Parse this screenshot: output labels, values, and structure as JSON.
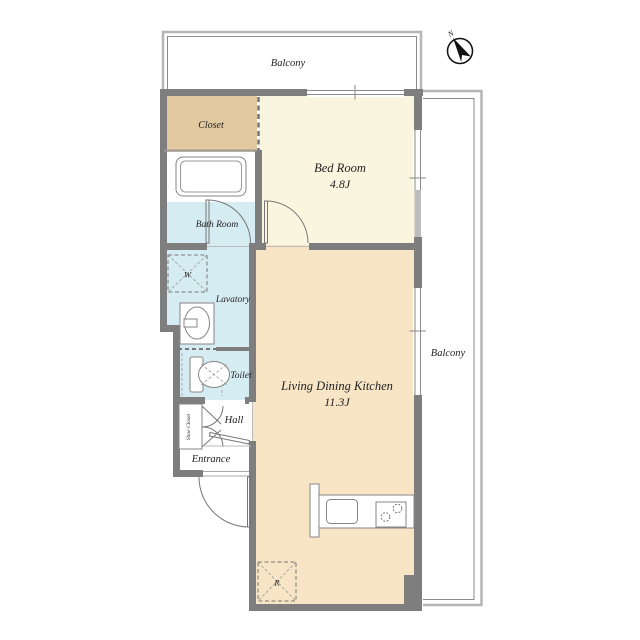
{
  "plan": {
    "compass": {
      "label": "N"
    },
    "balconies": {
      "top": "Balcony",
      "right": "Balcony"
    },
    "rooms": {
      "closet": {
        "label": "Closet"
      },
      "bedroom": {
        "label": "Bed Room",
        "size": "4.8J"
      },
      "bathroom": {
        "label": "Bath Room"
      },
      "lavatory": {
        "label": "Lavatory"
      },
      "toilet": {
        "label": "Toilet"
      },
      "hall": {
        "label": "Hall"
      },
      "shoe_closet": {
        "label": "Shoe Closet"
      },
      "entrance": {
        "label": "Entrance"
      },
      "ldk": {
        "label": "Living Dining Kitchen",
        "size": "11.3J"
      }
    },
    "symbols": {
      "washing_machine": "W",
      "refrigerator": "R"
    },
    "colors": {
      "wall": "#7e7e7e",
      "bedroom_cream": "#f9f5de",
      "ldk_peach": "#f7e5c6",
      "closet_tan": "#e2c9a0",
      "wet_area_blue": "#d6ecf3",
      "balcony_line": "#b5b5b5"
    }
  }
}
